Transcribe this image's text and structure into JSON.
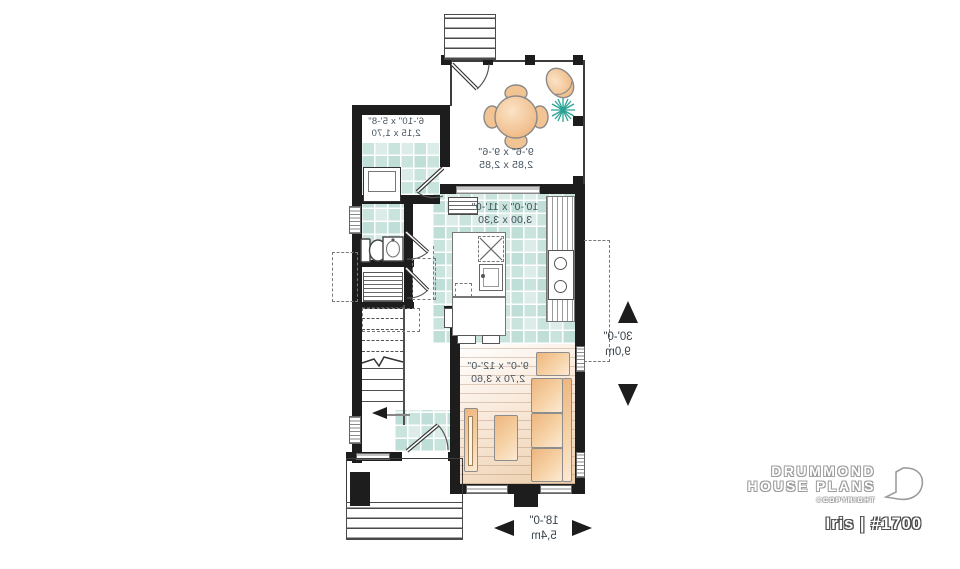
{
  "brand": {
    "line1": "DRUMMOND",
    "line2": "HOUSE PLANS",
    "copyright": "©COPYRIGHT",
    "plan": "Iris | #1700"
  },
  "rooms": {
    "terrace": {
      "ft": "9'-6\" x 9'-6\"",
      "m": "2,85 x 2,85"
    },
    "laundry": {
      "ft": "6'-10\" x 5'-8\"",
      "m": "2,15 x 1,70"
    },
    "kitchen": {
      "ft": "10'-0\" x 11'-0\"",
      "m": "3,00 x 3,30"
    },
    "living": {
      "ft": "9'-0\" x 12'-0\"",
      "m": "2,70 x 3,60"
    }
  },
  "overall": {
    "width": {
      "ft": "18'-0\"",
      "m": "5,4m"
    },
    "depth": {
      "ft": "30'-0\"",
      "m": "9,0m"
    }
  },
  "colors": {
    "wall": "#1d1d1d",
    "tile_floor": "#dcece8",
    "wood_floor": "#f2d6ba",
    "furniture": "#f2c08b",
    "plant": "#2ba394",
    "label_text": "#46535e",
    "logo_outline": "#9c9c9c"
  }
}
